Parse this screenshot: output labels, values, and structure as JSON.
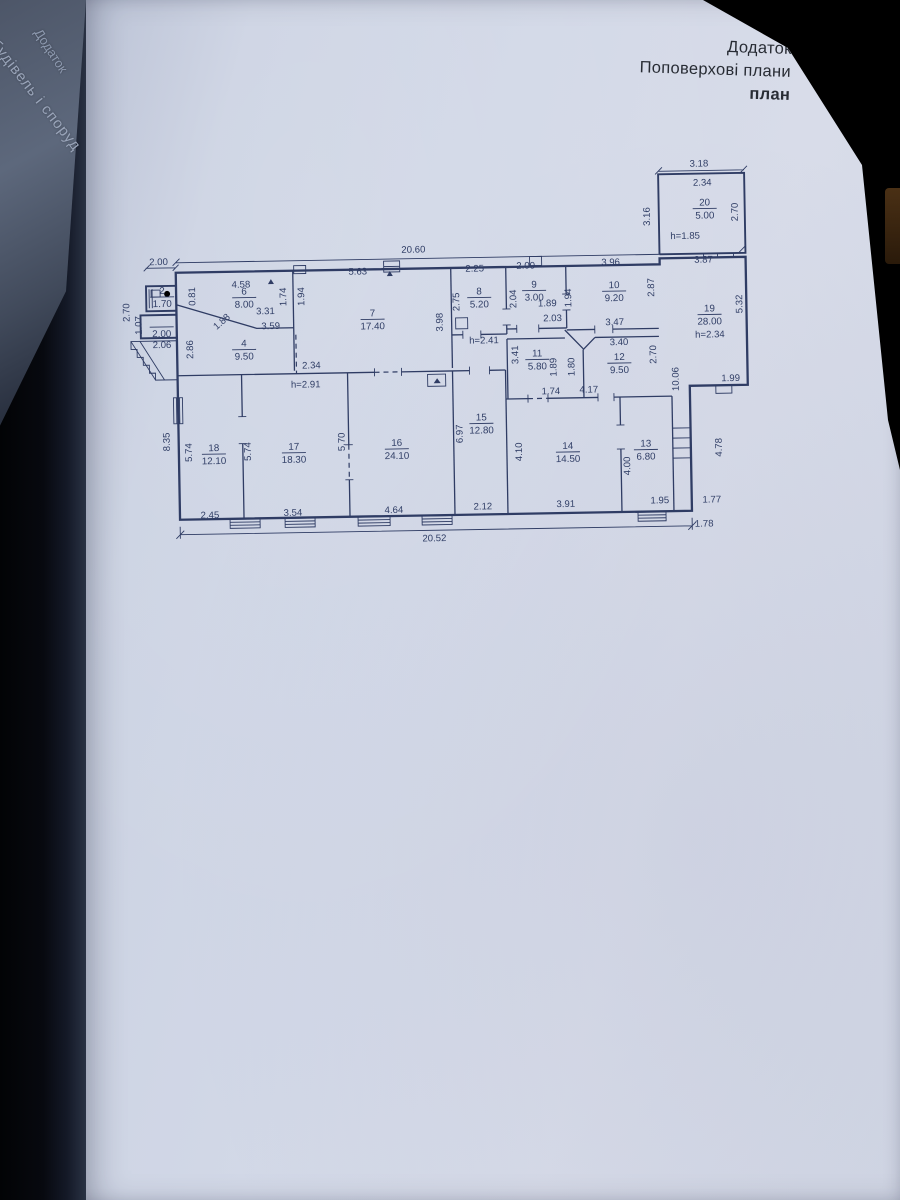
{
  "header": {
    "line1": "Додаток",
    "line2": "Поповерхові плани",
    "line3": "план"
  },
  "spine": {
    "fragment1": "Додаток",
    "fragment2": "ня будівель і споруд"
  },
  "plan": {
    "rooms": [
      {
        "num": "2",
        "area": "1.70",
        "x": 164,
        "y": 291
      },
      {
        "num": "",
        "area": "2.00",
        "x": 163,
        "y": 321
      },
      {
        "num": "6",
        "area": "8.00",
        "x": 246,
        "y": 293
      },
      {
        "num": "4",
        "area": "9.50",
        "x": 245,
        "y": 345
      },
      {
        "num": "7",
        "area": "17.40",
        "x": 374,
        "y": 317
      },
      {
        "num": "8",
        "area": "5.20",
        "x": 481,
        "y": 297
      },
      {
        "num": "9",
        "area": "3.00",
        "x": 536,
        "y": 291
      },
      {
        "num": "10",
        "area": "9.20",
        "x": 616,
        "y": 293
      },
      {
        "num": "11",
        "area": "5.80",
        "x": 538,
        "y": 360
      },
      {
        "num": "12",
        "area": "9.50",
        "x": 620,
        "y": 365
      },
      {
        "num": "13",
        "area": "6.80",
        "x": 645,
        "y": 452
      },
      {
        "num": "14",
        "area": "14.50",
        "x": 567,
        "y": 453
      },
      {
        "num": "15",
        "area": "12.80",
        "x": 481,
        "y": 423
      },
      {
        "num": "16",
        "area": "24.10",
        "x": 396,
        "y": 447
      },
      {
        "num": "17",
        "area": "18.30",
        "x": 293,
        "y": 449
      },
      {
        "num": "18",
        "area": "12.10",
        "x": 213,
        "y": 449
      },
      {
        "num": "19",
        "area": "28.00",
        "extra": "h=2.34",
        "x": 711,
        "y": 318
      },
      {
        "num": "20",
        "area": "5.00",
        "x": 708,
        "y": 212
      }
    ],
    "dims": [
      {
        "t": "20.60",
        "x": 416,
        "y": 252
      },
      {
        "t": "2.00",
        "x": 161,
        "y": 260
      },
      {
        "t": "2.25",
        "x": 477,
        "y": 272
      },
      {
        "t": "2.00",
        "x": 528,
        "y": 270
      },
      {
        "t": "3.96",
        "x": 613,
        "y": 268
      },
      {
        "t": "3.87",
        "x": 706,
        "y": 267
      },
      {
        "t": "3.18",
        "x": 703,
        "y": 171
      },
      {
        "t": "2.34",
        "x": 706,
        "y": 190
      },
      {
        "t": "3.16",
        "x": 653,
        "y": 220,
        "r": -90
      },
      {
        "t": "2.70",
        "x": 741,
        "y": 217,
        "r": -90
      },
      {
        "t": "h=1.85",
        "x": 688,
        "y": 243
      },
      {
        "t": "5.32",
        "x": 744,
        "y": 309,
        "r": -90
      },
      {
        "t": "2.87",
        "x": 656,
        "y": 291,
        "r": -90
      },
      {
        "t": "2.70",
        "x": 657,
        "y": 358,
        "r": -90
      },
      {
        "t": "10.06",
        "x": 679,
        "y": 383,
        "r": -90
      },
      {
        "t": "1.99",
        "x": 731,
        "y": 386
      },
      {
        "t": "4.78",
        "x": 721,
        "y": 452,
        "r": -90
      },
      {
        "t": "1.77",
        "x": 710,
        "y": 507
      },
      {
        "t": "1.78",
        "x": 702,
        "y": 531
      },
      {
        "t": "4.58",
        "x": 243,
        "y": 284
      },
      {
        "t": "0.81",
        "x": 197,
        "y": 292,
        "r": -90
      },
      {
        "t": "1.74",
        "x": 288,
        "y": 294,
        "r": -90
      },
      {
        "t": "5.63",
        "x": 360,
        "y": 273
      },
      {
        "t": "1.94",
        "x": 306,
        "y": 294,
        "r": -90
      },
      {
        "t": "3.31",
        "x": 267,
        "y": 311
      },
      {
        "t": "3.59",
        "x": 272,
        "y": 326
      },
      {
        "t": "1.88",
        "x": 225,
        "y": 320,
        "r": -40
      },
      {
        "t": "2.86",
        "x": 194,
        "y": 345,
        "r": -90
      },
      {
        "t": "2.06",
        "x": 163,
        "y": 343
      },
      {
        "t": "1.07",
        "x": 143,
        "y": 320,
        "r": -90
      },
      {
        "t": "2.70",
        "x": 131,
        "y": 307,
        "r": -90
      },
      {
        "t": "3.98",
        "x": 444,
        "y": 322,
        "r": -90
      },
      {
        "t": "2.75",
        "x": 461,
        "y": 302,
        "r": -90
      },
      {
        "t": "2.04",
        "x": 518,
        "y": 300,
        "r": -90
      },
      {
        "t": "1.89",
        "x": 549,
        "y": 308
      },
      {
        "t": "2.03",
        "x": 554,
        "y": 323
      },
      {
        "t": "1.94",
        "x": 573,
        "y": 300,
        "r": -90
      },
      {
        "t": "3.47",
        "x": 616,
        "y": 328
      },
      {
        "t": "3.40",
        "x": 620,
        "y": 348
      },
      {
        "t": "3.41",
        "x": 519,
        "y": 356,
        "r": -90
      },
      {
        "t": "1.89",
        "x": 557,
        "y": 369,
        "r": -90
      },
      {
        "t": "1.80",
        "x": 575,
        "y": 369,
        "r": -90
      },
      {
        "t": "1.74",
        "x": 551,
        "y": 396
      },
      {
        "t": "4.17",
        "x": 589,
        "y": 395
      },
      {
        "t": "2.34",
        "x": 312,
        "y": 366
      },
      {
        "t": "h=2.91",
        "x": 306,
        "y": 385
      },
      {
        "t": "h=2.41",
        "x": 485,
        "y": 344
      },
      {
        "t": "8.35",
        "x": 169,
        "y": 437,
        "r": -90
      },
      {
        "t": "5.74",
        "x": 191,
        "y": 448,
        "r": -90
      },
      {
        "t": "5.74",
        "x": 250,
        "y": 448,
        "r": -90
      },
      {
        "t": "5.70",
        "x": 344,
        "y": 440,
        "r": -90
      },
      {
        "t": "6.97",
        "x": 462,
        "y": 434,
        "r": -90
      },
      {
        "t": "4.10",
        "x": 521,
        "y": 453,
        "r": -90
      },
      {
        "t": "4.00",
        "x": 629,
        "y": 469,
        "r": -90
      },
      {
        "t": "2.45",
        "x": 208,
        "y": 514
      },
      {
        "t": "3.54",
        "x": 291,
        "y": 513
      },
      {
        "t": "4.64",
        "x": 392,
        "y": 512
      },
      {
        "t": "2.12",
        "x": 481,
        "y": 510
      },
      {
        "t": "3.91",
        "x": 564,
        "y": 509
      },
      {
        "t": "1.95",
        "x": 658,
        "y": 507
      },
      {
        "t": "20.52",
        "x": 432,
        "y": 541
      }
    ]
  }
}
